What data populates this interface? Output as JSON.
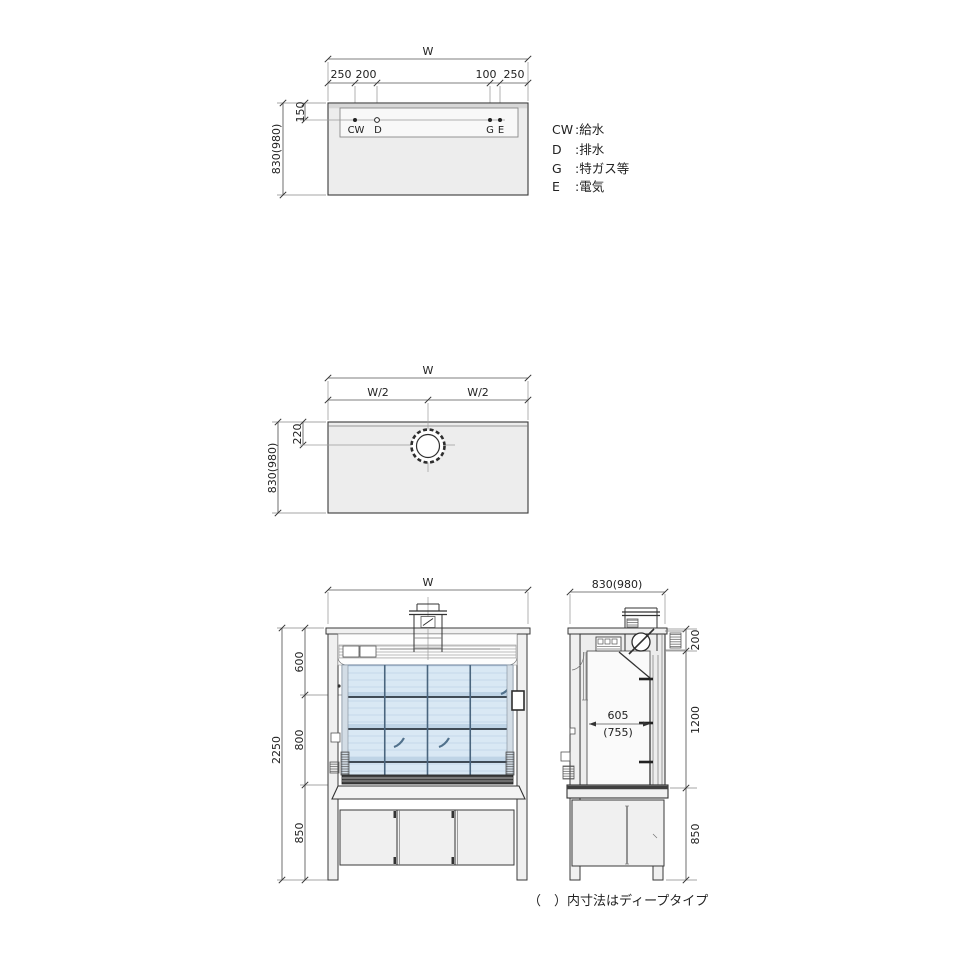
{
  "title": "fume-hood-dimension-drawing",
  "colors": {
    "glass": "#d9e8f4",
    "glass_stripe": "#c5d9ea",
    "glass_band": "#bfd4e6",
    "panel": "#ededed",
    "line": "#3a3a3a"
  },
  "service_plan": {
    "width_label": "W",
    "dim_250_left": "250",
    "dim_200": "200",
    "dim_100": "100",
    "dim_250_right": "250",
    "dim_150": "150",
    "depth": "830(980)",
    "pt_cw": "CW",
    "pt_d": "D",
    "pt_g": "G",
    "pt_e": "E"
  },
  "legend": {
    "items": [
      {
        "key": "CW",
        "label": ":給水"
      },
      {
        "key": "D",
        "label": ":排水"
      },
      {
        "key": "G",
        "label": ":特ガス等"
      },
      {
        "key": "E",
        "label": ":電気"
      }
    ]
  },
  "duct_plan": {
    "width_label": "W",
    "w_half_left": "W/2",
    "w_half_right": "W/2",
    "dim_220": "220",
    "depth": "830(980)"
  },
  "front_view": {
    "width_label": "W",
    "total_height": "2250",
    "upper": "600",
    "middle": "800",
    "lower": "850"
  },
  "side_view": {
    "depth": "830(980)",
    "top": "200",
    "chamber": "1200",
    "base": "850",
    "inner_depth": "605",
    "inner_depth_deep": "(755)"
  },
  "note": "（　）内寸法はディープタイプ"
}
